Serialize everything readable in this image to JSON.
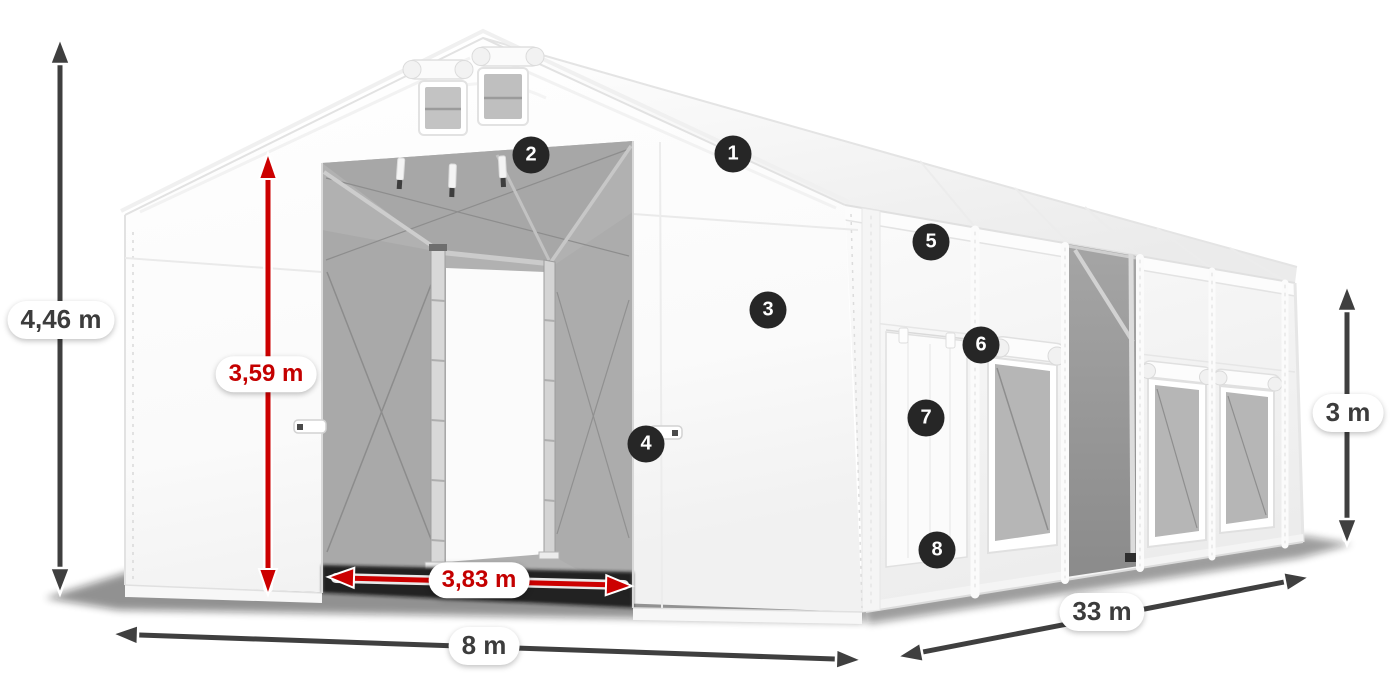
{
  "diagram": {
    "dimensions": {
      "total_height": "4,46 m",
      "entrance_height": "3,59 m",
      "entrance_width": "3,83 m",
      "front_width": "8 m",
      "side_length": "33 m",
      "side_height": "3 m"
    },
    "hotspots": [
      {
        "label": "1"
      },
      {
        "label": "2"
      },
      {
        "label": "3"
      },
      {
        "label": "4"
      },
      {
        "label": "5"
      },
      {
        "label": "6"
      },
      {
        "label": "7"
      },
      {
        "label": "8"
      }
    ],
    "colors": {
      "background": "#ffffff",
      "arrow_dark": "#3f3f3f",
      "arrow_red": "#cc0000",
      "label_text_dark": "#3c3c3c",
      "label_text_red": "#c40000",
      "hotspot_background": "#262626",
      "hotspot_text": "#ffffff",
      "tent_canvas": "#fdfdfd",
      "tent_interior": "#b1b1b1"
    }
  }
}
